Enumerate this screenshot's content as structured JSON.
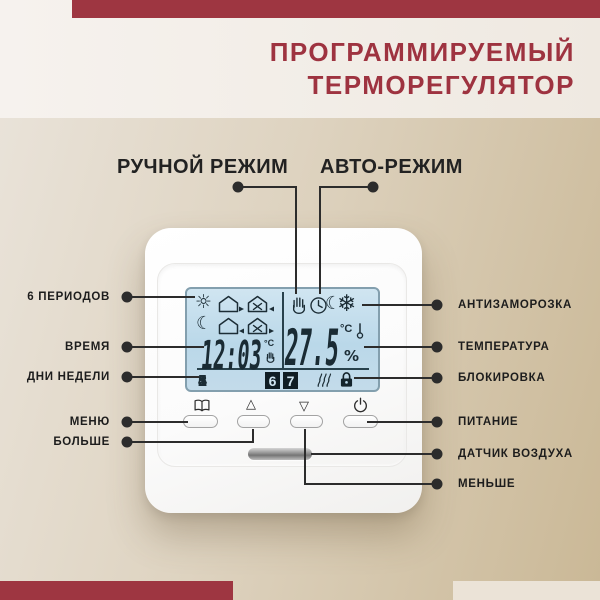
{
  "page": {
    "title_line1": "ПРОГРАММИРУЕМЫЙ",
    "title_line2": "ТЕРМОРЕГУЛЯТОР",
    "accent_color": "#9e3641",
    "corner_color": "#ebe3d7",
    "lcd_color": "#bad8e9"
  },
  "modes": {
    "manual": "РУЧНОЙ РЕЖИМ",
    "auto": "АВТО-РЕЖИМ"
  },
  "callouts_left": [
    {
      "label": "6 ПЕРИОДОВ"
    },
    {
      "label": "ВРЕМЯ"
    },
    {
      "label": "ДНИ НЕДЕЛИ"
    },
    {
      "label": "МЕНЮ"
    },
    {
      "label": "БОЛЬШЕ"
    }
  ],
  "callouts_right": [
    {
      "label": "АНТИЗАМОРОЗКА"
    },
    {
      "label": "ТЕМПЕРАТУРА"
    },
    {
      "label": "БЛОКИРОВКА"
    },
    {
      "label": "ПИТАНИЕ"
    },
    {
      "label": "ДАТЧИК ВОЗДУХА"
    },
    {
      "label": "МЕНЬШЕ"
    }
  ],
  "device": {
    "lcd": {
      "time": "12:03",
      "time_unit": "°C",
      "temperature": "27.5",
      "temp_unit": "°C",
      "percent": "%",
      "days": [
        "1",
        "2",
        "3",
        "4",
        "5"
      ],
      "active_days": [
        "6",
        "7"
      ],
      "icons_left": [
        "sun-icon",
        "house-arrow-right-icon",
        "house-work-arrow-left-icon",
        "moon-icon",
        "house-arrow-left-icon",
        "house-work-arrow-right-icon"
      ],
      "icons_right": [
        "hand-icon",
        "clock-icon",
        "moon-icon",
        "snowflake-icon"
      ],
      "icons_bottom": [
        "heat-waves-icon",
        "lock-icon"
      ],
      "sun_glyph": "☼",
      "moon_glyph": "☾",
      "snowflake_glyph": "❄"
    },
    "buttons": [
      "menu-button",
      "up-button",
      "down-button",
      "power-button"
    ],
    "button_icons": {
      "up_glyph": "△",
      "down_glyph": "▽"
    }
  }
}
